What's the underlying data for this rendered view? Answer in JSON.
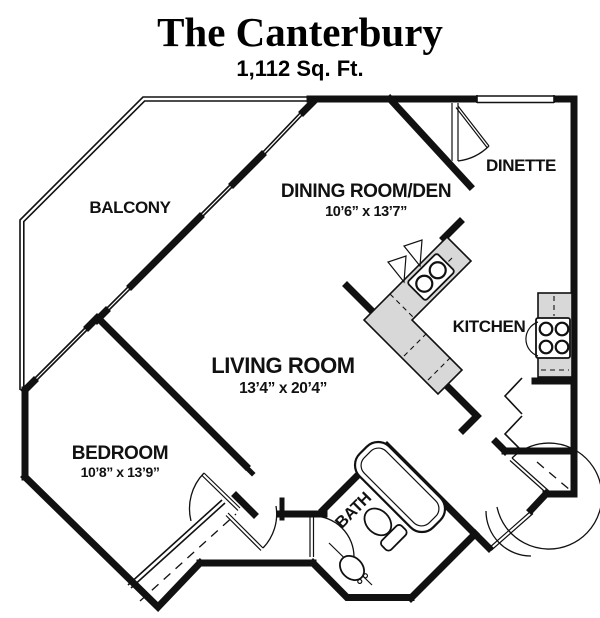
{
  "title": "The Canterbury",
  "subtitle": "1,112 Sq. Ft.",
  "rooms": {
    "balcony": {
      "label": "BALCONY"
    },
    "dining": {
      "label": "DINING ROOM/DEN",
      "dims": "10’6” x 13’7”"
    },
    "dinette": {
      "label": "DINETTE"
    },
    "kitchen": {
      "label": "KITCHEN"
    },
    "living": {
      "label": "LIVING ROOM",
      "dims": "13’4” x 20’4”"
    },
    "bedroom": {
      "label": "BEDROOM",
      "dims": "10’8” x 13’9”"
    },
    "bath": {
      "label": "BATH"
    }
  },
  "colors": {
    "wall": "#111111",
    "counter": "#d8d8d8",
    "background": "#ffffff"
  }
}
